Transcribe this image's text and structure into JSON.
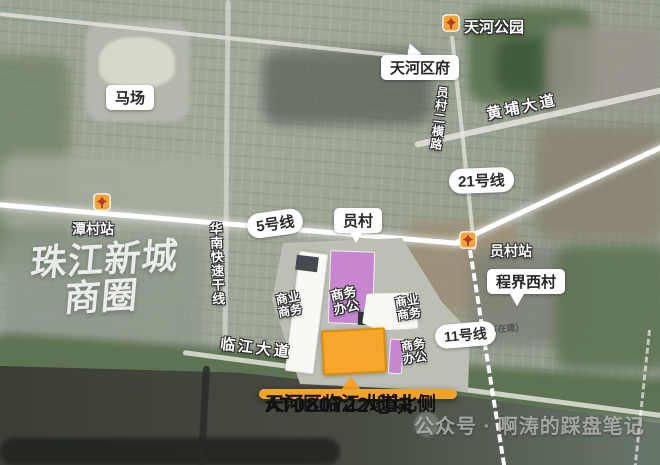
{
  "stations": {
    "tianhe_park": "天河公园",
    "tancun": "潭村站",
    "yuancun": "员村站"
  },
  "callouts": {
    "racecourse": "马场",
    "tianhe_district_gov": "天河区府",
    "yuancun_village": "员村",
    "chengjie_west_village": "程界西村"
  },
  "roads": {
    "huangpu_avenue": "黄埔大道",
    "yuancun_erheng_road": "员村二横路",
    "huanan_expressway": "华南快速干线",
    "linjiang_avenue": "临江大道"
  },
  "metro": {
    "line5": "5号线",
    "line21": "21号线",
    "line11": "11号线",
    "under_construction": "（在建）"
  },
  "district_overlay": {
    "line1": "珠江新城",
    "line2": "商圈"
  },
  "plots": {
    "left_commercial": {
      "line1": "商业",
      "line2": "商务"
    },
    "center_office": {
      "line1": "商务",
      "line2": "办公"
    },
    "right_commercial": {
      "line1": "商业",
      "line2": "商务"
    },
    "south_office": {
      "line1": "商务",
      "line2": "办公"
    }
  },
  "main_callout": {
    "line1": "天河区临江大道北侧",
    "line2": "AT080722地块"
  },
  "watermark": "公众号 · 啊涛的踩盘笔记",
  "colors": {
    "plot_orange": "#f6a72b",
    "plot_orange_border": "#de8d08",
    "plot_purple": "#c687cf",
    "callout_orange": "#f2a32c",
    "metro_icon_bg": "#f0a43c",
    "metro_icon_glyph": "#b63a26",
    "metro_line": "#ffffff",
    "river": "#3b3e35"
  }
}
